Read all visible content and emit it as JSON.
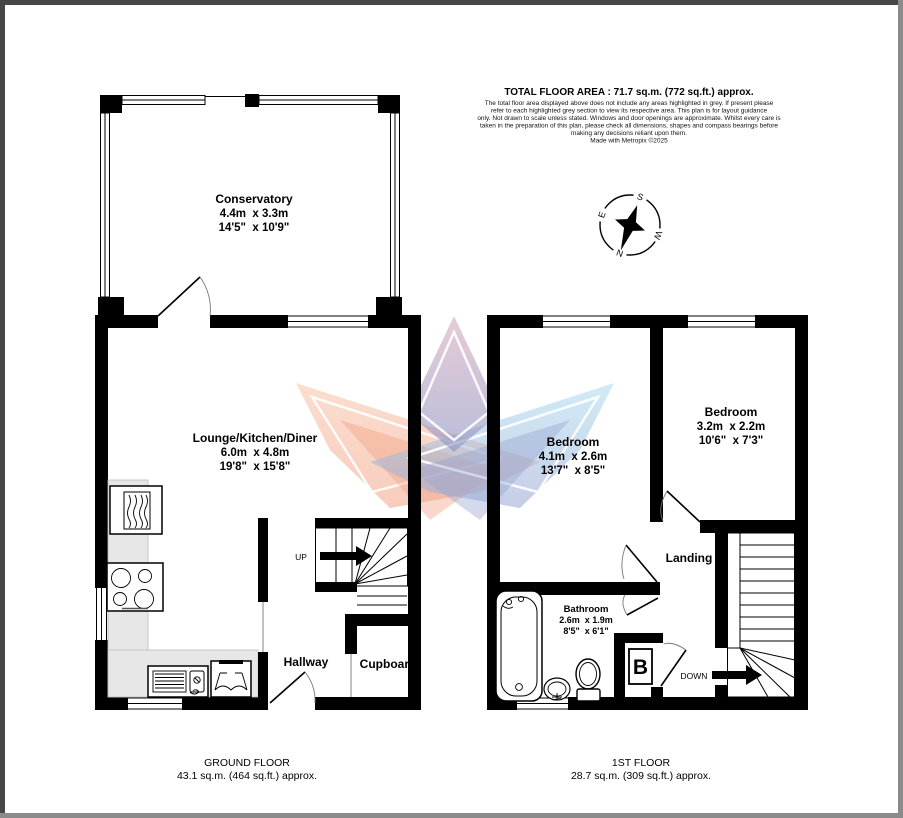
{
  "header": {
    "title": "TOTAL FLOOR AREA : 71.7 sq.m. (772 sq.ft.) approx.",
    "disclaimer_lines": [
      "The total floor area displayed above does not include any areas highlighted in grey. If present please",
      "refer to each highlighted grey section to view its respective area. This plan is for layout guidance",
      "only. Not drawn to scale unless stated. Windows and door openings are approximate. Whilst every care is",
      "taken in the preparation of this plan, please check all dimensions, shapes and compass bearings before",
      "making any decisions reliant upon them.",
      "Made with Metropix ©2025"
    ]
  },
  "compass": {
    "n": "N",
    "s": "S",
    "e": "E",
    "w": "W"
  },
  "ground_floor": {
    "conservatory": {
      "name": "Conservatory",
      "dims_m": "4.4m  x 3.3m",
      "dims_ft": "14'5\"  x 10'9\""
    },
    "lounge": {
      "name": "Lounge/Kitchen/Diner",
      "dims_m": "6.0m  x 4.8m",
      "dims_ft": "19'8\"  x 15'8\""
    },
    "hallway": {
      "name": "Hallway"
    },
    "cupboard": {
      "name": "Cupboard"
    },
    "stairs_label": "UP",
    "floor_label": "GROUND FLOOR",
    "floor_area": "43.1 sq.m. (464 sq.ft.) approx."
  },
  "first_floor": {
    "bedroom1": {
      "name": "Bedroom",
      "dims_m": "4.1m  x 2.6m",
      "dims_ft": "13'7\"  x 8'5\""
    },
    "bedroom2": {
      "name": "Bedroom",
      "dims_m": "3.2m  x 2.2m",
      "dims_ft": "10'6\"  x 7'3\""
    },
    "bathroom": {
      "name": "Bathroom",
      "dims_m": "2.6m  x 1.9m",
      "dims_ft": "8'5\"  x 6'1\""
    },
    "landing": {
      "name": "Landing"
    },
    "boiler": "B",
    "stairs_label": "DOWN",
    "floor_label": "1ST FLOOR",
    "floor_area": "28.7 sq.m. (309 sq.ft.) approx."
  }
}
